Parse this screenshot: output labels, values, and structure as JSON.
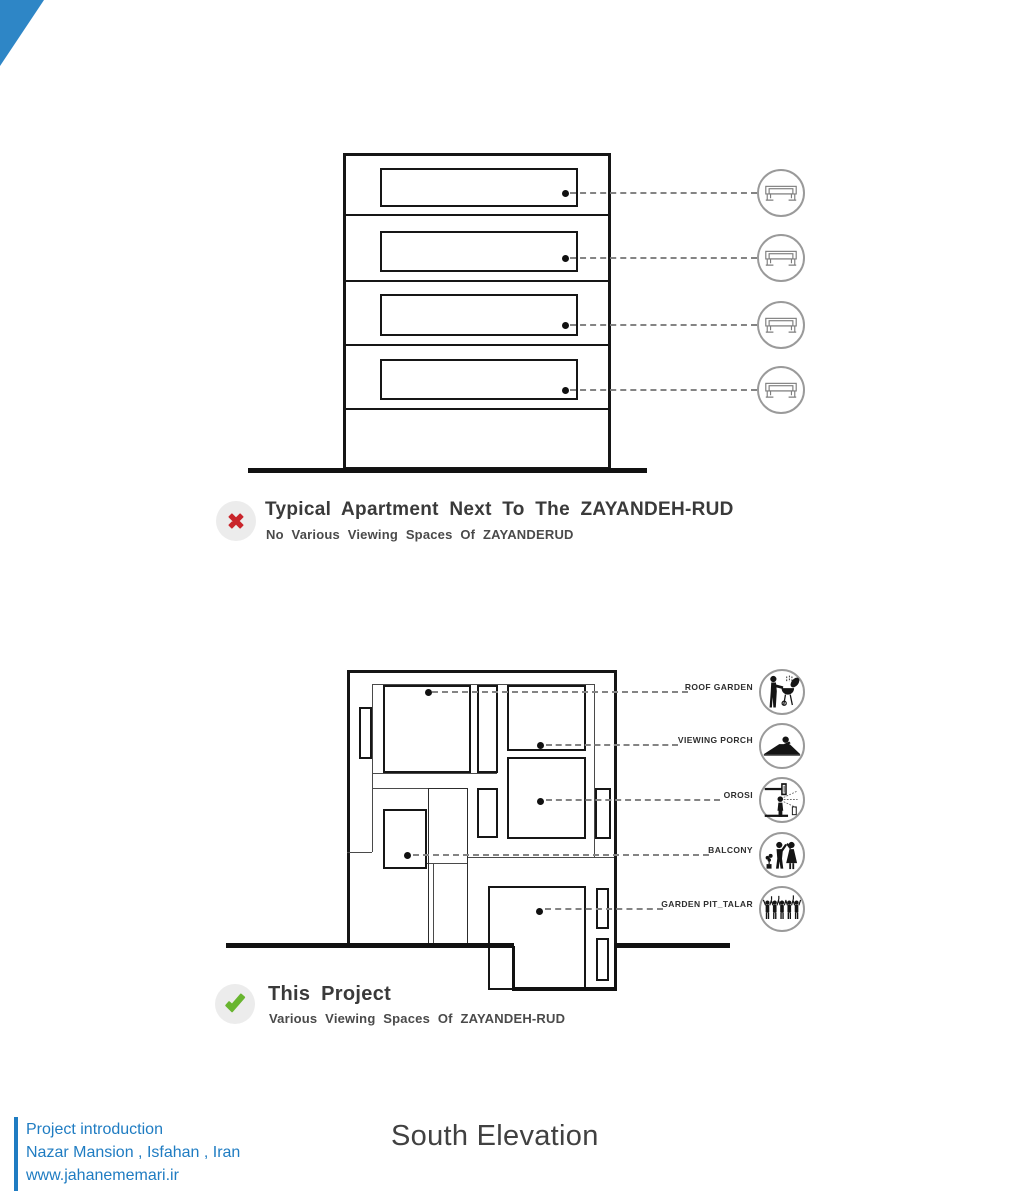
{
  "corner_ribbon": {
    "color": "#2e86c6"
  },
  "top_diagram": {
    "badge": {
      "icon": "x-mark-icon",
      "color": "#c9252b",
      "background": "#ececec"
    },
    "title": "Typical Apartment Next To The ZAYANDEH-RUD",
    "subtitle": "No Various Viewing Spaces Of ZAYANDERUD",
    "floor_count": 4,
    "legend_icon": "bench-sofa-icon",
    "legend_rows": 4
  },
  "bottom_diagram": {
    "badge": {
      "icon": "check-mark-icon",
      "color": "#68b52f",
      "background": "#ececec"
    },
    "title": "This Project",
    "subtitle": "Various Viewing Spaces Of ZAYANDEH-RUD",
    "legend": [
      {
        "label": "ROOF GARDEN",
        "icon": "barbecue-person-icon"
      },
      {
        "label": "VIEWING PORCH",
        "icon": "reclining-person-icon"
      },
      {
        "label": "OROSI",
        "icon": "person-at-window-icon"
      },
      {
        "label": "BALCONY",
        "icon": "family-waving-icon"
      },
      {
        "label": "GARDEN PIT_TALAR",
        "icon": "crowd-celebration-icon"
      }
    ]
  },
  "footer": {
    "accent_color": "#1f7cc2",
    "lines": [
      "Project introduction",
      "Nazar Mansion , Isfahan , Iran",
      "www.jahanememari.ir"
    ],
    "drawing_title": "South Elevation"
  },
  "drawing_colors": {
    "ink": "#161616",
    "leader": "#848484",
    "circle_border": "#9a9a9a"
  }
}
